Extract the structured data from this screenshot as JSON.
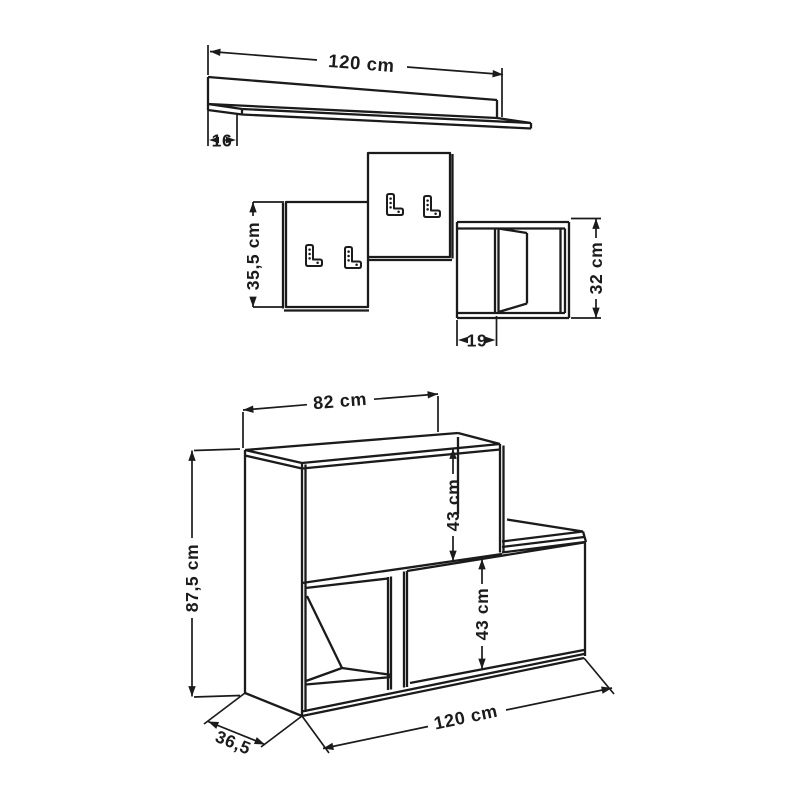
{
  "diagram": {
    "background_color": "#ffffff",
    "line_color": "#1b1b1b",
    "items": {
      "wall_shelf": {
        "width": "120 cm",
        "depth": "16"
      },
      "hook_panels": {
        "height": "35,5 cm"
      },
      "wall_cube": {
        "height": "32 cm",
        "depth": "19"
      },
      "hall_bench": {
        "top_width": "82 cm",
        "upper_compartment_height": "43 cm",
        "lower_compartment_height": "43 cm",
        "height": "87,5 cm",
        "width": "120 cm",
        "depth": "36,5"
      }
    }
  }
}
